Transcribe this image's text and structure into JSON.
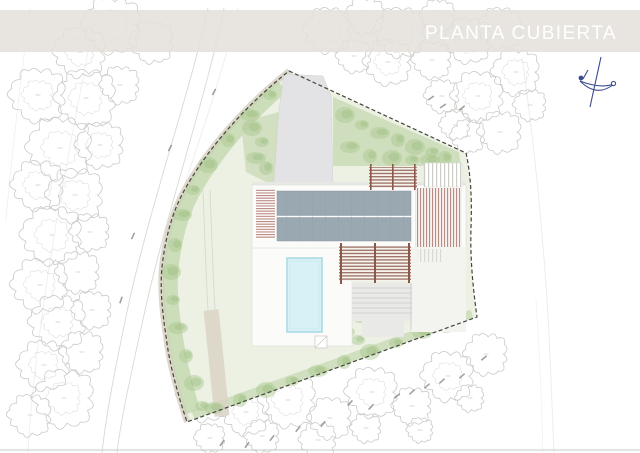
{
  "header": {
    "title": "PLANTA CUBIERTA",
    "band_color": "#e4e1da",
    "title_color": "#ffffff"
  },
  "compass": {
    "label": "north-arrow",
    "color": "#3d4c8f"
  },
  "plan": {
    "colors": {
      "roof_panel": "#9aa8b1",
      "roof_panel_seam": "#8d9aa3",
      "pool_water": "#d8f1f6",
      "pool_edge": "#abdbe4",
      "pergola_slat": "#8a5848",
      "louver_stripe": "#9b564a",
      "gray_louver": "#c9c9c4",
      "vegetation_tuft": "#a9c78e",
      "vegetation_patch": "#ccdbb8",
      "garden_band": "#c2d5ab",
      "lawn": "#ecf1e4",
      "driveway": "#e3e3e5",
      "path_band": "#dad4c6",
      "tree_outline": "#c9cbc7",
      "contour_line": "#d8d8d5",
      "boundary_line": "#45453f",
      "building_white": "#fbfbf9"
    }
  }
}
